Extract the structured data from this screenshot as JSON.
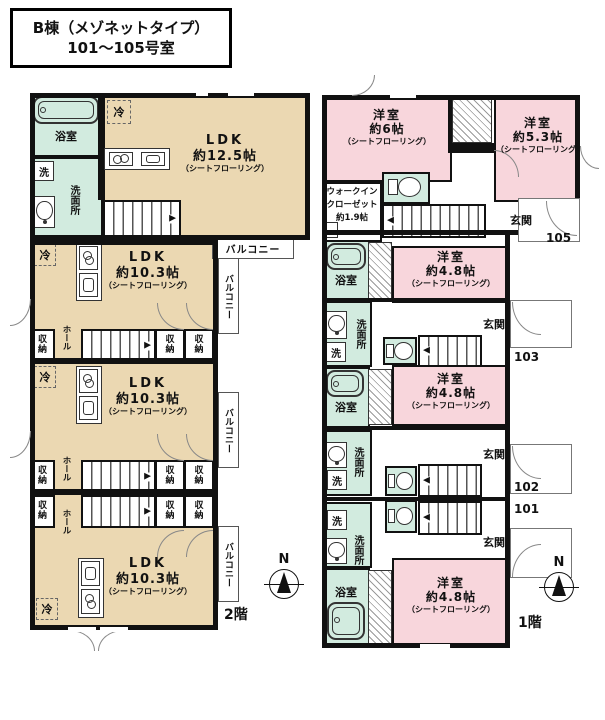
{
  "title": {
    "line1": "B棟（メゾネットタイプ）",
    "line2": "101〜105号室"
  },
  "floors": {
    "f2": "2階",
    "f1": "1階"
  },
  "compass_n": "N",
  "common": {
    "ldk": "LDK",
    "bedroom": "洋室",
    "flooring": "（シートフローリング）",
    "balcony": "バルコニー",
    "bath": "浴室",
    "washroom": "洗面所",
    "washer": "洗",
    "fridge": "冷",
    "hall": "ホール",
    "storage": "収納",
    "entrance": "玄関"
  },
  "f2_units": [
    {
      "size": "約12.5帖"
    },
    {
      "size": "約10.3帖"
    },
    {
      "size": "約10.3帖"
    },
    {
      "size": "約10.3帖"
    }
  ],
  "f1_rooms": [
    {
      "size": "約6帖"
    },
    {
      "size": "約5.3帖"
    },
    {
      "size": "約4.8帖"
    },
    {
      "size": "約4.8帖"
    },
    {
      "size": "約4.8帖"
    }
  ],
  "wic": {
    "line1": "ウォークイン",
    "line2": "クローゼット",
    "line3": "約1.9帖"
  },
  "units": {
    "u105": "105",
    "u103": "103",
    "u102": "102",
    "u101": "101"
  },
  "colors": {
    "ldk": "#ebd8b2",
    "bedroom": "#f8d6dc",
    "wet": "#d2ebdf",
    "wall": "#111111"
  }
}
